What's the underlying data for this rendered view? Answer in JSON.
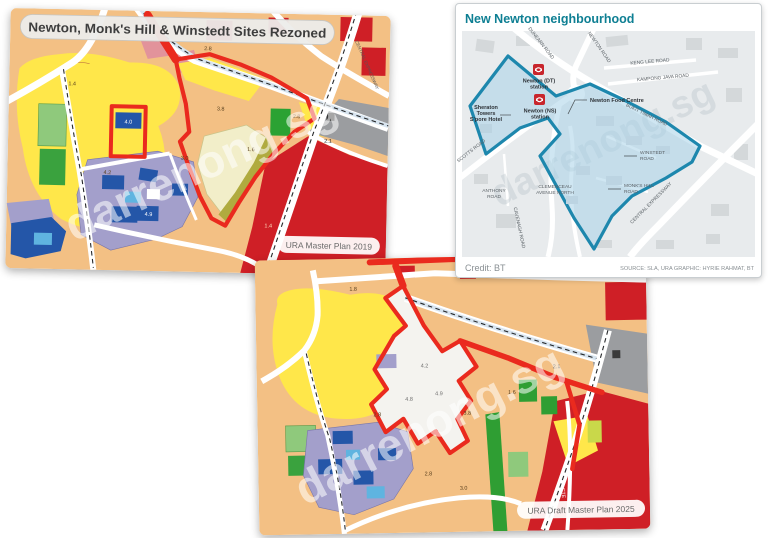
{
  "watermark": "darrenong.sg",
  "map2019": {
    "title": "Newton, Monk's Hill & Winstedt Sites Rezoned",
    "badge": "URA Master Plan 2019",
    "cte_label": "CENTRAL EXPRESSWAY",
    "parcels": [
      "1.4",
      "2.8",
      "4.0",
      "4.2",
      "3.8",
      "1.6",
      "2.8",
      "1.4",
      "4.9",
      "2.1",
      "3.0"
    ]
  },
  "btmap": {
    "title": "New Newton neighbourhood",
    "credit": "Credit: BT",
    "source": "SOURCE: SLA, URA   GRAPHIC: HYRIE RAHMAT, BT",
    "stations": [
      {
        "l1": "Newton (DT)",
        "l2": "station"
      },
      {
        "l1": "Newton (NS)",
        "l2": "station"
      }
    ],
    "hotel": [
      "Sheraton",
      "Towers",
      "S'pore Hotel"
    ],
    "food_centre": "Newton Food Centre",
    "roads": {
      "dunearn": "DUNEARN ROAD",
      "newton": "NEWTON ROAD",
      "keng_lee": "KENG LEE ROAD",
      "kampong_java": "KAMPONG JAVA ROAD",
      "scotts": "SCOTTS ROAD",
      "bukit_timah": "BUKIT TIMAH ROAD",
      "winstedt": [
        "WINSTEDT",
        "ROAD"
      ],
      "monks_hill": [
        "MONK'S HILL",
        "ROAD"
      ],
      "anthony": [
        "ANTHONY",
        "ROAD"
      ],
      "clemenceau": [
        "CLEMENCEAU",
        "AVENUE NORTH"
      ],
      "cavenagh": "CAVENAGH ROAD",
      "cte": "CENTRAL EXPRESSWAY"
    }
  },
  "map2025": {
    "badge": "URA Draft Master Plan 2025",
    "cte_label": "CTE",
    "parcels": [
      "1.8",
      "4.2",
      "4.9",
      "4.8",
      "2.8",
      "3.8",
      "2.1",
      "2.8",
      "3.0",
      "1.6"
    ]
  },
  "colors": {
    "boundary_red": "#ea2a1e",
    "boundary_blue": "#1d87ad",
    "accent_teal": "#0e7f93",
    "station_red": "#c8252c",
    "zone_yellow": "#ffe74a",
    "zone_orange": "#f3c084",
    "zone_red": "#cf1f26",
    "zone_purple": "#a39fcb",
    "zone_blue": "#2456a8",
    "zone_lightblue": "#5fb4e0",
    "zone_green": "#2f9e33",
    "zone_gray": "#9b9da0"
  }
}
